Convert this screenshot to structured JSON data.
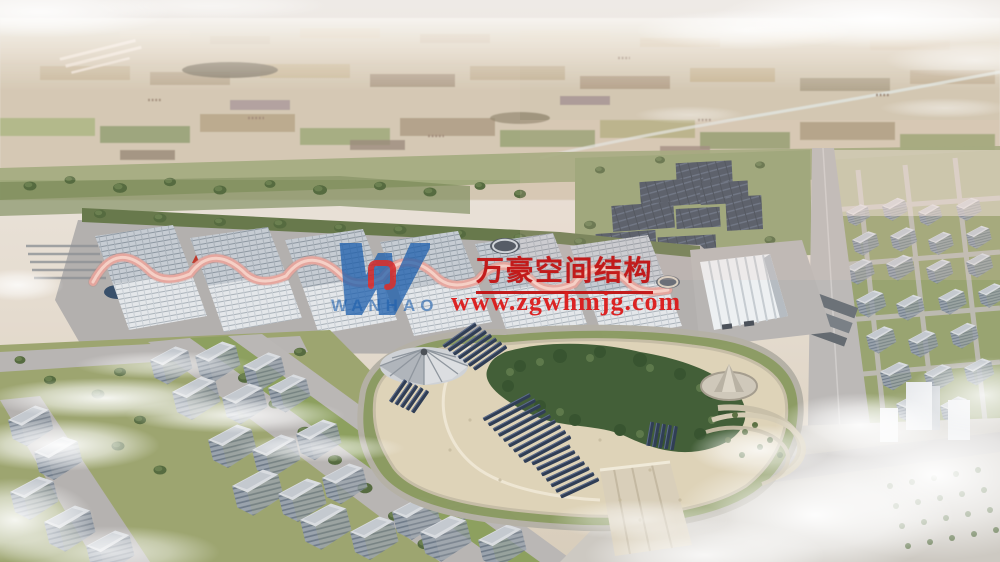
{
  "image": {
    "title": "Exhibition complex aerial rendering",
    "type": "architectural-rendering"
  },
  "watermark": {
    "logo": "wanhao-w-logo",
    "logo_color": "#1d5fad",
    "logo_accent_color": "#d42020",
    "company_en": "WANHAO",
    "company_cn": "万豪空间结构",
    "website": "www.zgwhmjg.com",
    "cn_color": "#c21313",
    "url_color": "#dc1a1a",
    "en_color": "#1d5fad"
  },
  "scene": {
    "sky_haze_color": "#ece9e5",
    "hall_ridge_color": "#e8a59c",
    "solar_panel_color": "#3c4858",
    "park_sand_color": "#ded3b8",
    "exhibition_halls_count": 6,
    "elements": [
      "farmland-horizon",
      "exhibition-halls",
      "membrane-roof-ridges",
      "solar-farm",
      "central-park",
      "umbrella-tent",
      "cone-pavilion",
      "white-ribbed-hall",
      "city-blocks",
      "fog-clouds"
    ]
  }
}
